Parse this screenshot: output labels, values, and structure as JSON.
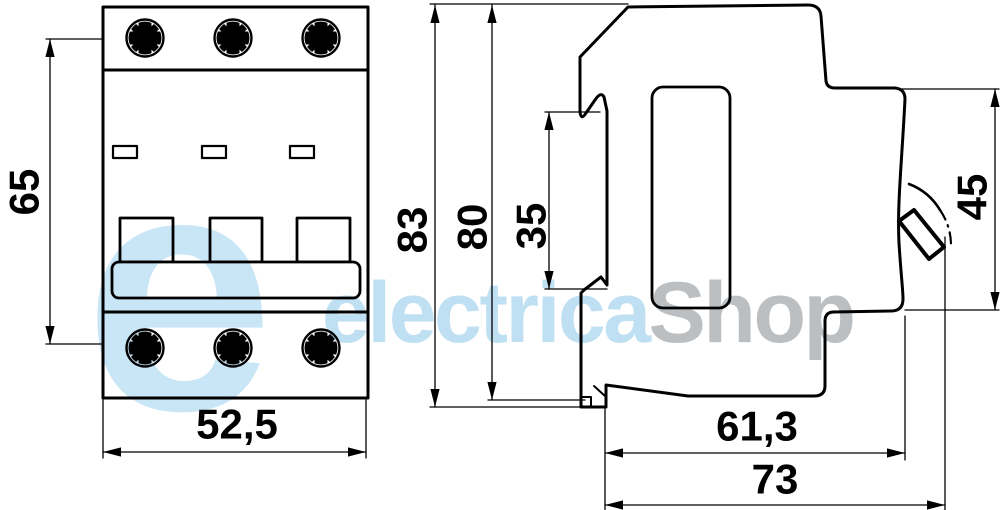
{
  "watermark": {
    "logo_glyph": "e",
    "brand": {
      "primary": "electrica",
      "secondary": "Shop"
    },
    "colors": {
      "primary": "#bfe0f2",
      "secondary": "#bcbfc2"
    }
  },
  "front_view": {
    "dimensions": {
      "height": "65",
      "width": "52,5"
    }
  },
  "side_view": {
    "dimensions": {
      "overall_height": "83",
      "body_height": "80",
      "din_rail_slot": "35",
      "front_section_height": "45",
      "body_depth": "61,3",
      "overall_depth": "73"
    }
  },
  "line_color": "#000000"
}
